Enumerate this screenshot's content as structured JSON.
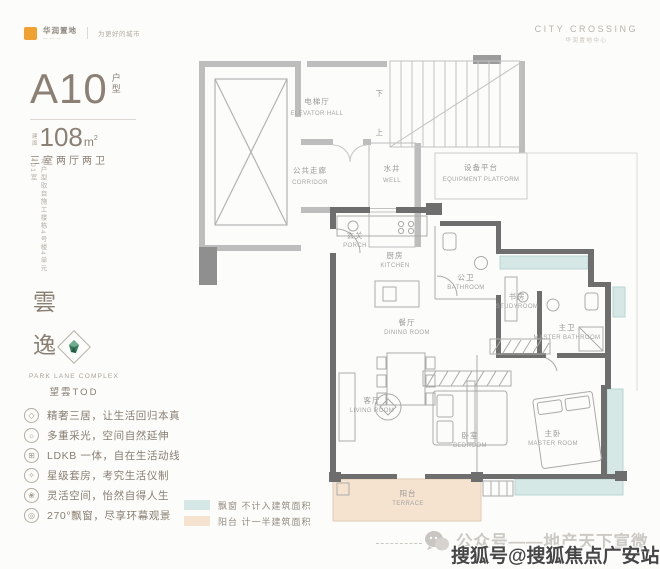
{
  "brand": {
    "logo_cn": "华润置地",
    "logo_tagline": "为更好的城市",
    "top_right_en": "CITY CROSSING",
    "top_right_cn": "华润置地中心"
  },
  "unit": {
    "name": "A10",
    "suffix_chars": [
      "户",
      "型"
    ],
    "area_prefix_chars": [
      "建",
      "面"
    ],
    "area_value": "108",
    "area_unit": "m",
    "area_sup": "2",
    "layout": "三室两厅两卫",
    "disclaimer": "本户型取自施工楼栋4号楼4单元401室"
  },
  "project": {
    "name_chars": [
      "雲",
      "逸"
    ],
    "logo_en": "PARK LANE COMPLEX",
    "logo_cn": "望雲TOD"
  },
  "features": [
    {
      "icon": "gem-icon",
      "glyph": "◇",
      "text": "精奢三居，让生活回归本真"
    },
    {
      "icon": "sun-icon",
      "glyph": "☼",
      "text": "多重采光，空间自然延伸"
    },
    {
      "icon": "layout-icon",
      "glyph": "⊞",
      "text": "LDKB 一体，自在生活动线"
    },
    {
      "icon": "star-icon",
      "glyph": "✧",
      "text": "星级套房，考究生活仪制"
    },
    {
      "icon": "flower-icon",
      "glyph": "❀",
      "text": "灵活空间，怡然自得人生"
    },
    {
      "icon": "view-icon",
      "glyph": "◎",
      "text": "270°飘窗，尽享环幕观景"
    }
  ],
  "floorplan": {
    "stairs": {
      "down": "下",
      "up": "上"
    },
    "rooms": [
      {
        "cn": "电梯厅",
        "en": "ELEVATOR HALL"
      },
      {
        "cn": "公共走廊",
        "en": "CORRIDOR"
      },
      {
        "cn": "水井",
        "en": "WELL"
      },
      {
        "cn": "设备平台",
        "en": "EQUIPMENT PLATFORM"
      },
      {
        "cn": "玄关",
        "en": "PORCH"
      },
      {
        "cn": "厨房",
        "en": "KITCHEN"
      },
      {
        "cn": "公卫",
        "en": "BATHROOM"
      },
      {
        "cn": "书房",
        "en": "STUDYROOM"
      },
      {
        "cn": "主卫",
        "en": "MASTER BATHROOM"
      },
      {
        "cn": "餐厅",
        "en": "DINING ROOM"
      },
      {
        "cn": "客厅",
        "en": "LIVING ROOM"
      },
      {
        "cn": "卧室",
        "en": "BEDROOM"
      },
      {
        "cn": "主卧",
        "en": "MASTER ROOM"
      },
      {
        "cn": "阳台",
        "en": "TERRACE"
      }
    ],
    "colors": {
      "accent_orange": "#f0a132",
      "bay_window": "#d5e8e6",
      "bay_window_edge": "#b7d6d3",
      "terrace": "#f5e3cf",
      "terrace_edge": "#e3cdb2",
      "wall_dark": "#6e6e6e",
      "wall_light": "#bdbdbd"
    }
  },
  "legend": [
    {
      "swatch": "#d5e8e6",
      "label": "飘窗",
      "desc": "不计入建筑面积"
    },
    {
      "swatch": "#f5e3cf",
      "label": "阳台",
      "desc": "计一半建筑面积"
    }
  ],
  "watermarks": {
    "wechat_account": "公众号——地产天下宣微",
    "sohu_account": "搜狐号@搜狐焦点广安站"
  }
}
